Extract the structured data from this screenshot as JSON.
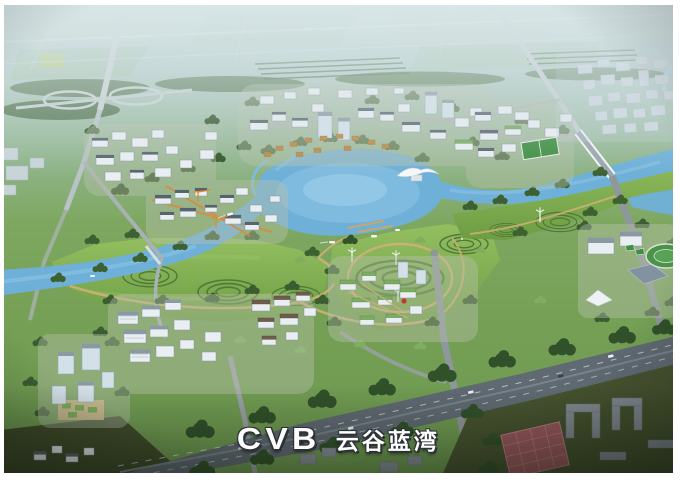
{
  "logo": {
    "brand": "CVB",
    "name": "云谷蓝湾"
  },
  "palette": {
    "sky_haze": "#c8d9dd",
    "farmland": "#a3bfae",
    "forest": "#3e6132",
    "lawn": "#7ca94f",
    "water": "#6fb0d8",
    "water_light": "#8fc6e5",
    "road": "#98a1a6",
    "highway": "#606a73",
    "path_tan": "#cdb078",
    "building_wall": "#e9eef2",
    "building_roof": "#57636d",
    "green_roof": "#7cab62",
    "accent_orange": "#e08a2f",
    "court_red": "#9d5a5f",
    "logo_text": "#fdfdfd",
    "logo_outline": "#2b3136"
  }
}
